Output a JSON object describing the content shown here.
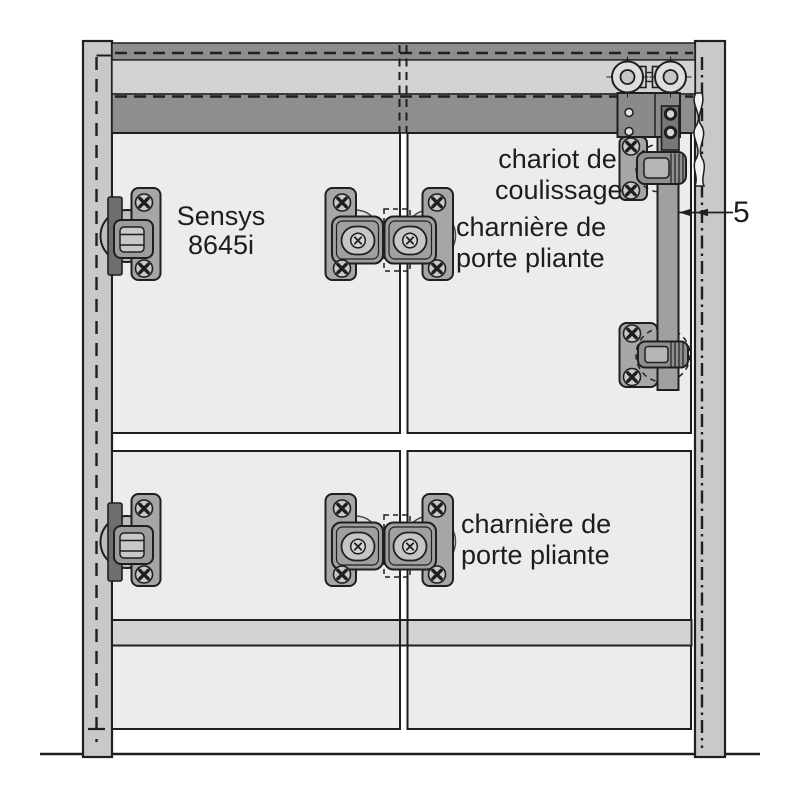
{
  "labels": {
    "hinge_model": {
      "line1": "Sensys",
      "line2": "8645i"
    },
    "carriage": {
      "line1": "chariot de",
      "line2": "coulissage"
    },
    "folding_hinge_top": {
      "line1": "charnière de",
      "line2": "porte pliante"
    },
    "folding_hinge_bottom": {
      "line1": "charnière de",
      "line2": "porte pliante"
    },
    "item_number": "5"
  },
  "colors": {
    "outline": "#1f1f1f",
    "post": "#c9c9c9",
    "rail_dark": "#8e8e8e",
    "band_light": "#d3d3d3",
    "panel": "#ececec",
    "fitting": "#a6a6a6",
    "fitting_dark": "#6e6e6e",
    "cup": "#a0a0a0",
    "metal_light": "#c9c9c9",
    "text": "#1d1d1d",
    "bg": "#ffffff"
  }
}
